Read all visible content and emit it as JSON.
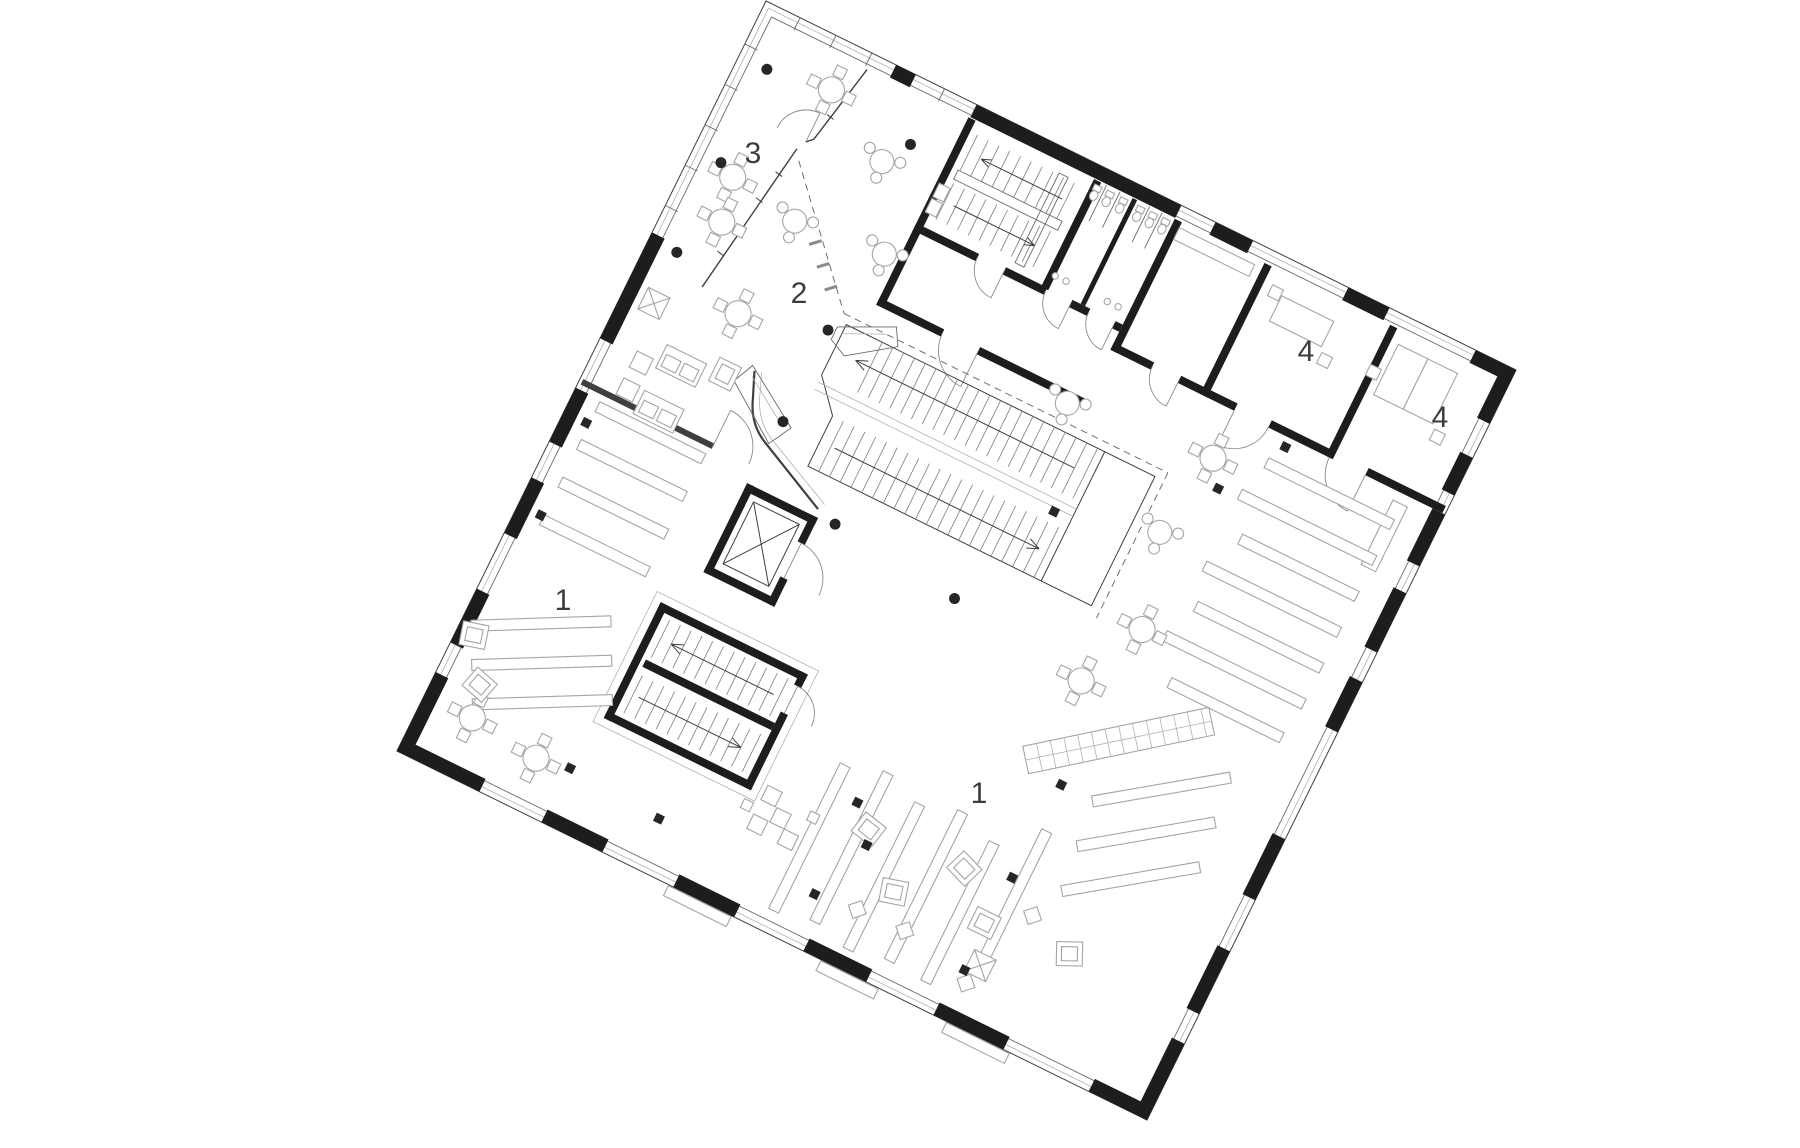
{
  "plan": {
    "room_labels": {
      "room_3": "3",
      "room_2": "2",
      "room_1_left": "1",
      "room_1_main": "1",
      "room_4_north": "4",
      "room_4_east": "4"
    }
  },
  "colors": {
    "background": "#ffffff",
    "wall": "#1d1d1b",
    "line_dark": "#3f3f3e",
    "line_medium": "#6f6f6e",
    "furniture_line": "#a5a5a3"
  }
}
